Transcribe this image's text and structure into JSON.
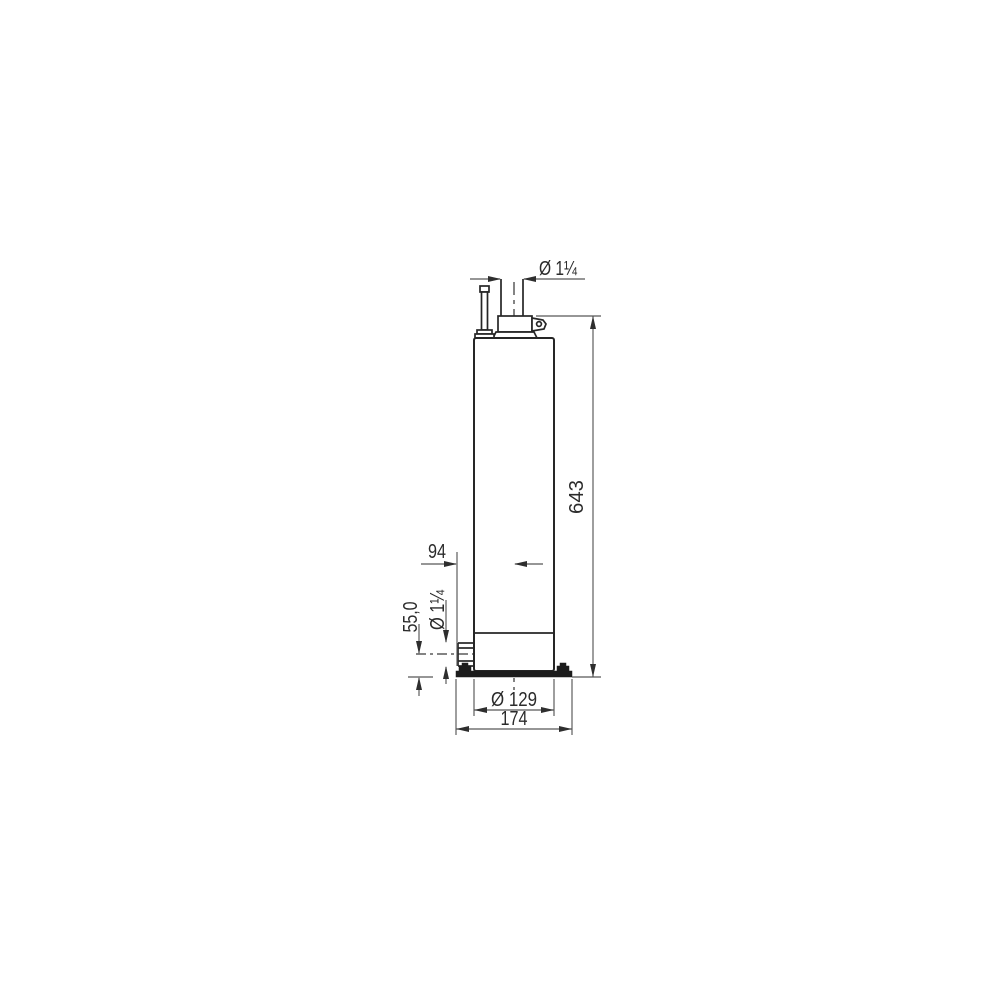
{
  "drawing": {
    "kind": "technical dimension drawing",
    "subject": "cylindrical submersible pump, side view",
    "colors": {
      "background": "#ffffff",
      "object_line": "#262626",
      "dimension_line": "#575757",
      "text": "#2b2b2b",
      "base_fill": "#1c1c1c"
    }
  },
  "dimensions": {
    "discharge_diameter": "Ø 1¼",
    "overall_height": "643",
    "inlet_offset": "94",
    "inlet_diameter": "Ø 1¼",
    "inlet_center_height": "55,0",
    "body_diameter": "Ø 129",
    "base_width": "174"
  }
}
